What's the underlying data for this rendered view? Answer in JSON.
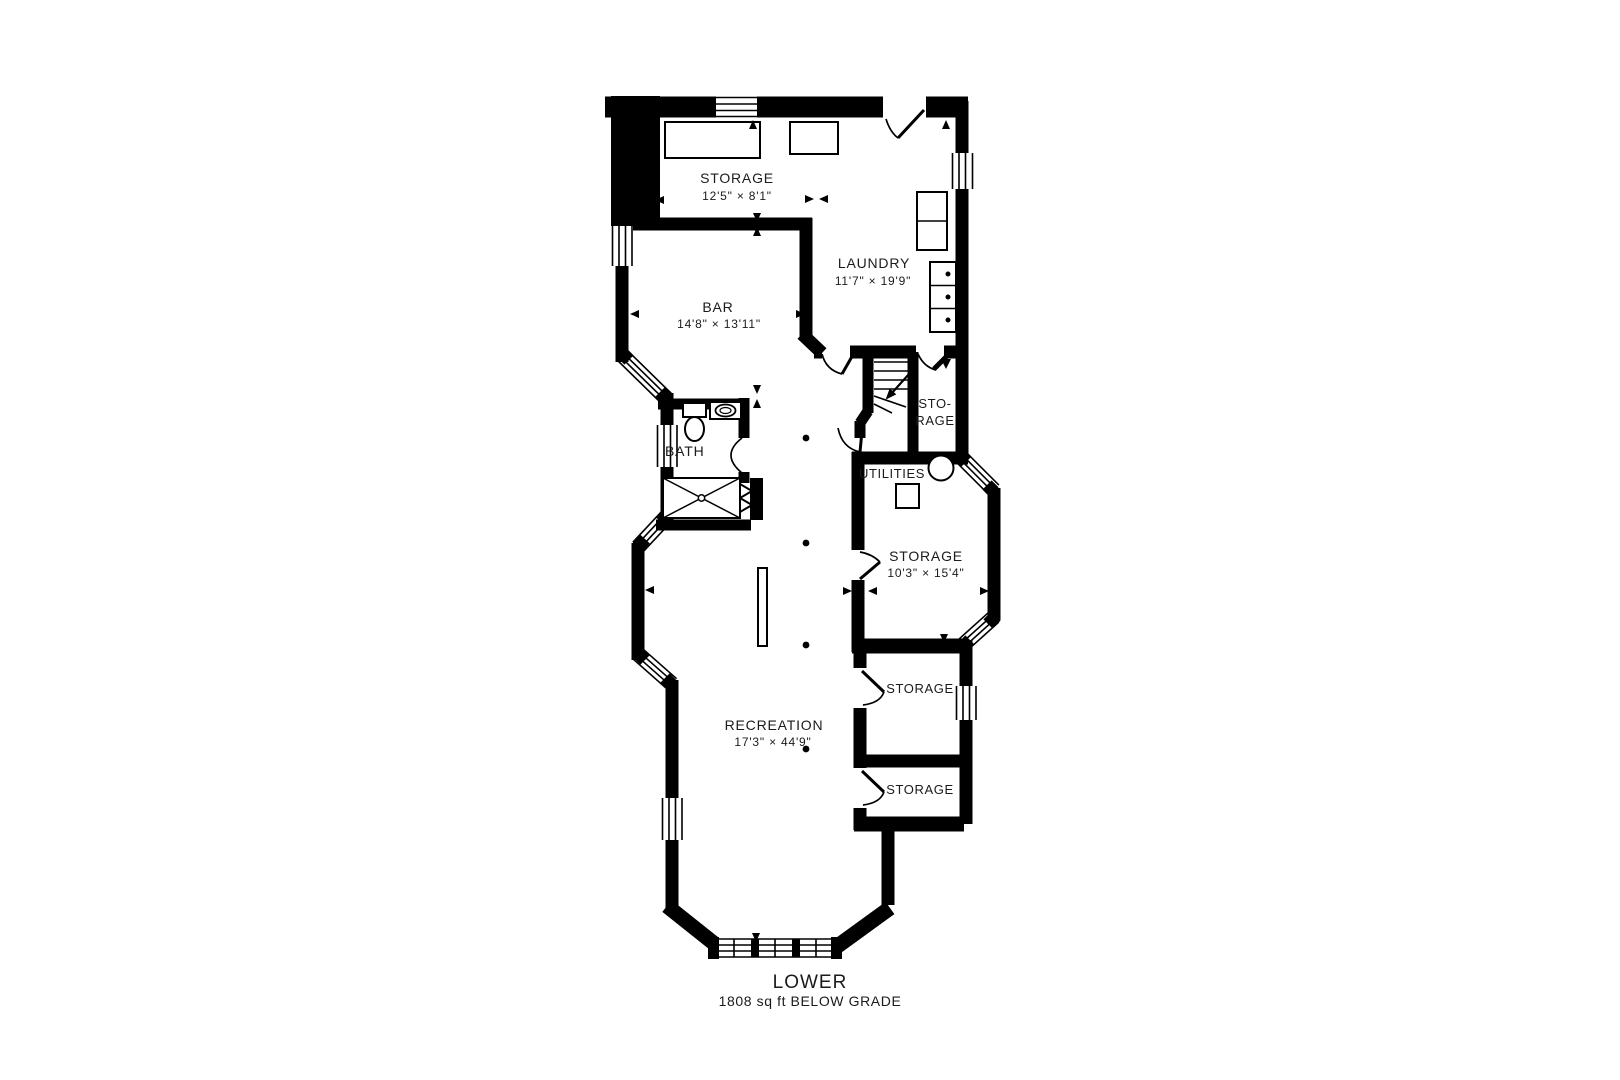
{
  "page": {
    "background": "#ffffff",
    "wall_color": "#000000",
    "text_color": "#1b1b1b"
  },
  "floor": {
    "title": "LOWER",
    "subtitle": "1808 sq ft BELOW GRADE",
    "rooms": [
      {
        "id": "storage-top",
        "name": "STORAGE",
        "dims": "12'5\" × 8'1\""
      },
      {
        "id": "laundry",
        "name": "LAUNDRY",
        "dims": "11'7\" × 19'9\""
      },
      {
        "id": "bar",
        "name": "BAR",
        "dims": "14'8\" × 13'11\""
      },
      {
        "id": "bath",
        "name": "BATH"
      },
      {
        "id": "storage-stairs",
        "line1": "STO-",
        "line2": "RAGE"
      },
      {
        "id": "utilities",
        "name": "UTILITIES"
      },
      {
        "id": "storage-middle",
        "name": "STORAGE",
        "dims": "10'3\" × 15'4\""
      },
      {
        "id": "recreation",
        "name": "RECREATION",
        "dims": "17'3\" × 44'9\""
      },
      {
        "id": "storage-lower-1",
        "name": "STORAGE"
      },
      {
        "id": "storage-lower-2",
        "name": "STORAGE"
      }
    ]
  }
}
